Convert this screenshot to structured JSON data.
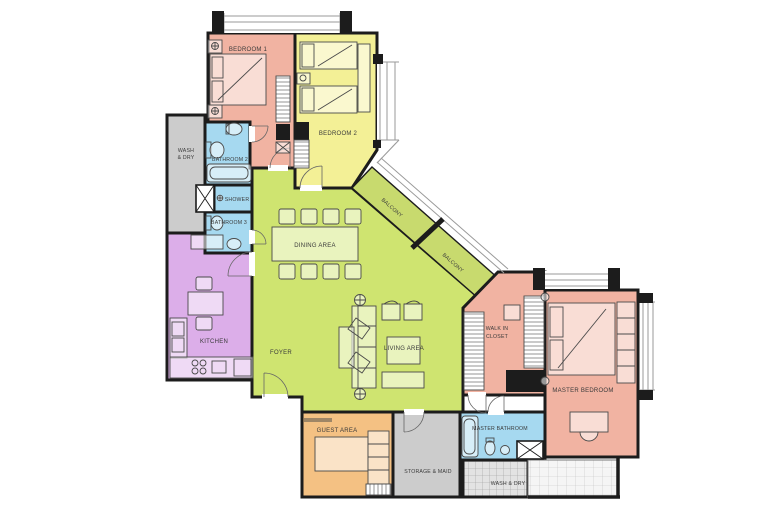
{
  "plan": {
    "background": "#ffffff",
    "wall_color": "#1c1c1c",
    "rooms": {
      "bedroom1": {
        "label": "BEDROOM 1",
        "color": "#f1b3a2"
      },
      "bedroom2": {
        "label": "BEDROOM 2",
        "color": "#f3f096"
      },
      "wash_dry_left": {
        "line1": "WASH",
        "line2": "& DRY",
        "color": "#cccccc"
      },
      "bathroom2": {
        "label": "BATHROOM 2",
        "color": "#a6d9f0"
      },
      "shower": {
        "label": "SHOWER",
        "color": "#a6d9f0"
      },
      "bathroom3": {
        "label": "BATHROOM 3",
        "color": "#a6d9f0"
      },
      "kitchen": {
        "label": "KITCHEN",
        "color": "#dcaee9"
      },
      "dining": {
        "label": "DINING AREA",
        "color": "#cfe470"
      },
      "foyer": {
        "label": "FOYER"
      },
      "living": {
        "label": "LIVING AREA"
      },
      "balcony_upper": {
        "label": "BALCONY",
        "color": "#c8da6e"
      },
      "balcony_lower": {
        "label": "BALCONY"
      },
      "walk_in_closet": {
        "line1": "WALK IN",
        "line2": "CLOSET",
        "color": "#f1b3a2"
      },
      "master_bedroom": {
        "label": "MASTER BEDROOM",
        "color": "#f1b3a2"
      },
      "master_bathroom": {
        "label": "MASTER BATHROOM",
        "color": "#a6d9f0"
      },
      "guest": {
        "label": "GUEST AREA",
        "color": "#f4c183"
      },
      "storage": {
        "label": "STORAGE & MAID",
        "color": "#cccccc"
      },
      "wash_dry_right": {
        "label": "WASH & DRY"
      }
    }
  }
}
